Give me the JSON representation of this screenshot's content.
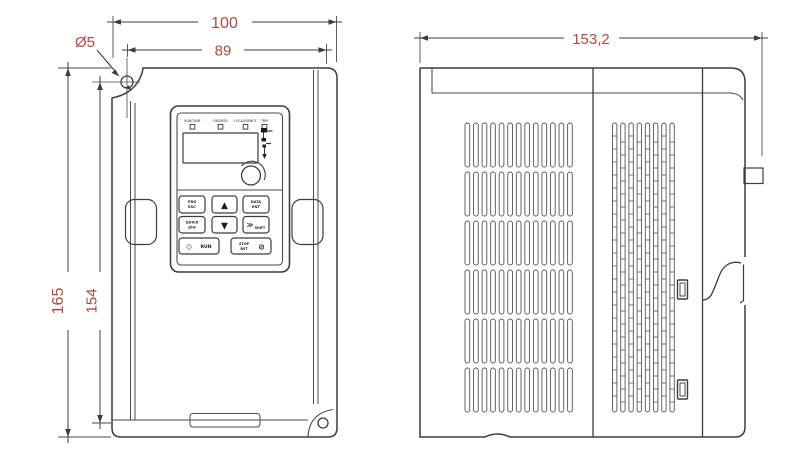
{
  "drawing": {
    "kind": "technical-dimension-drawing",
    "subject": "frequency inverter (VFD) front view and side view",
    "accent_color": "#b04a42",
    "line_color": "#3c3c3c"
  },
  "dimensions": {
    "overall_width": "100",
    "mount_hole_pitch_width": "89",
    "mount_hole_diameter": "Ø5",
    "overall_height": "165",
    "mount_hole_pitch_height": "154",
    "overall_depth": "153,2"
  },
  "keypad": {
    "led_labels": [
      "RUN/TUNE",
      "FWD/REV",
      "LOCAL/REMOT",
      "TRIP"
    ],
    "buttons": {
      "prg": [
        "PRG",
        "ESC"
      ],
      "enter": [
        "DATA",
        "ENT"
      ],
      "up": "▲",
      "down": "▼",
      "quick": [
        "QUICK",
        "JOG"
      ],
      "shift_glyph": "≫",
      "shift": "SHIFT",
      "run_glyph": "◇",
      "run": "RUN",
      "stop": [
        "STOP",
        "RST"
      ],
      "stop_glyph": "⊘"
    }
  }
}
